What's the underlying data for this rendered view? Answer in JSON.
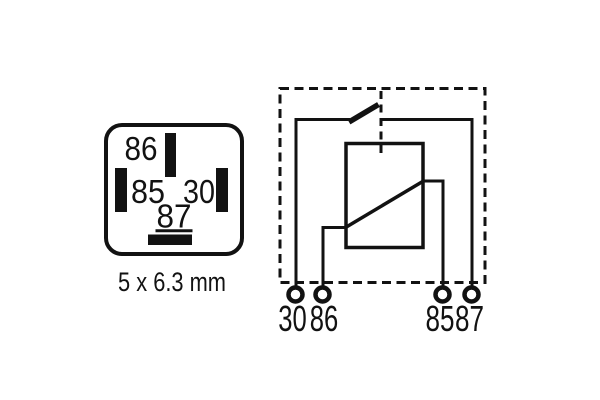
{
  "colors": {
    "ink": "#121212",
    "background": "#ffffff"
  },
  "socket_view": {
    "pins": [
      {
        "label": "86",
        "position": "top"
      },
      {
        "label": "85",
        "position": "left"
      },
      {
        "label": "30",
        "position": "right"
      },
      {
        "label": "87",
        "position": "bottom"
      }
    ],
    "caption": "5 x 6.3 mm"
  },
  "schematic": {
    "terminals": [
      {
        "label": "30"
      },
      {
        "label": "86"
      },
      {
        "label": "85"
      },
      {
        "label": "87"
      }
    ]
  }
}
